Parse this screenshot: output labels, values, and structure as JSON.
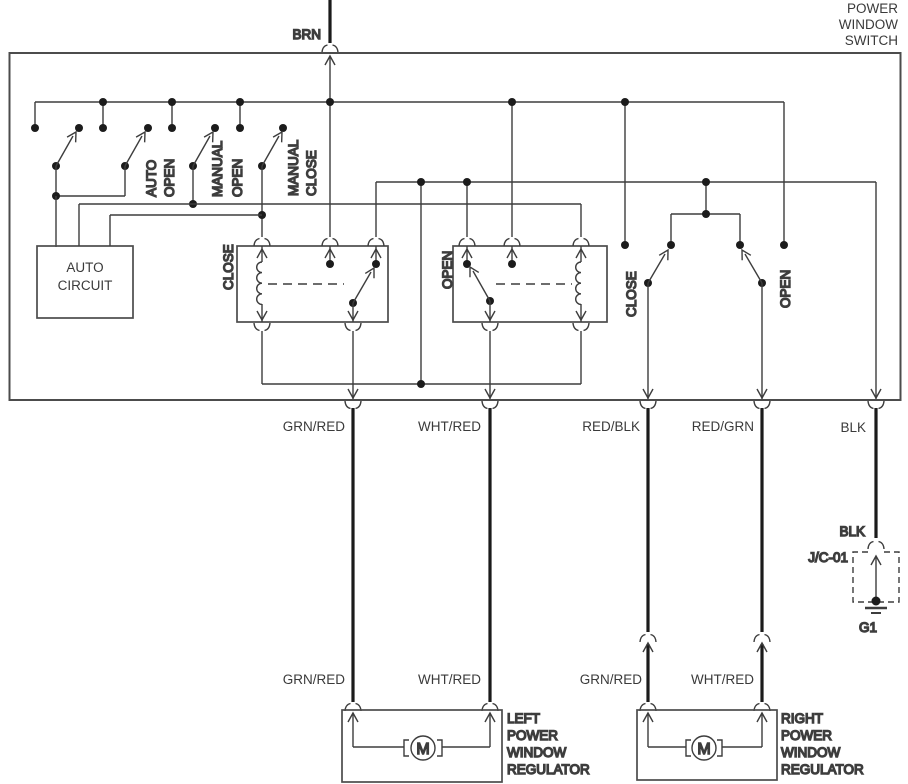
{
  "power_window_switch": {
    "title_lines": [
      "POWER",
      "WINDOW",
      "SWITCH"
    ],
    "feed_wire": "BRN",
    "switch_labels": {
      "auto_open": [
        "AUTO",
        "OPEN"
      ],
      "manual_open": [
        "MANUAL",
        "OPEN"
      ],
      "manual_close": [
        "MANUAL",
        "CLOSE"
      ]
    },
    "auto_circuit_lines": [
      "AUTO",
      "CIRCUIT"
    ],
    "close_relay_label": "CLOSE",
    "open_relay_label": "OPEN",
    "right_contact_labels": {
      "close": "CLOSE",
      "open": "OPEN"
    }
  },
  "output_wires": {
    "grn_red": "GRN/RED",
    "wht_red": "WHT/RED",
    "red_blk": "RED/BLK",
    "red_grn": "RED/GRN",
    "blk": "BLK"
  },
  "motor_wires": {
    "left_grn_red": "GRN/RED",
    "left_wht_red": "WHT/RED",
    "right_grn_red": "GRN/RED",
    "right_wht_red": "WHT/RED"
  },
  "ground": {
    "wire": "BLK",
    "junction_label": "J/C-01",
    "point_label": "G1"
  },
  "left_regulator": {
    "name_lines": [
      "LEFT",
      "POWER",
      "WINDOW",
      "REGULATOR"
    ],
    "motor_letter": "M"
  },
  "right_regulator": {
    "name_lines": [
      "RIGHT",
      "POWER",
      "WINDOW",
      "REGULATOR"
    ],
    "motor_letter": "M"
  }
}
